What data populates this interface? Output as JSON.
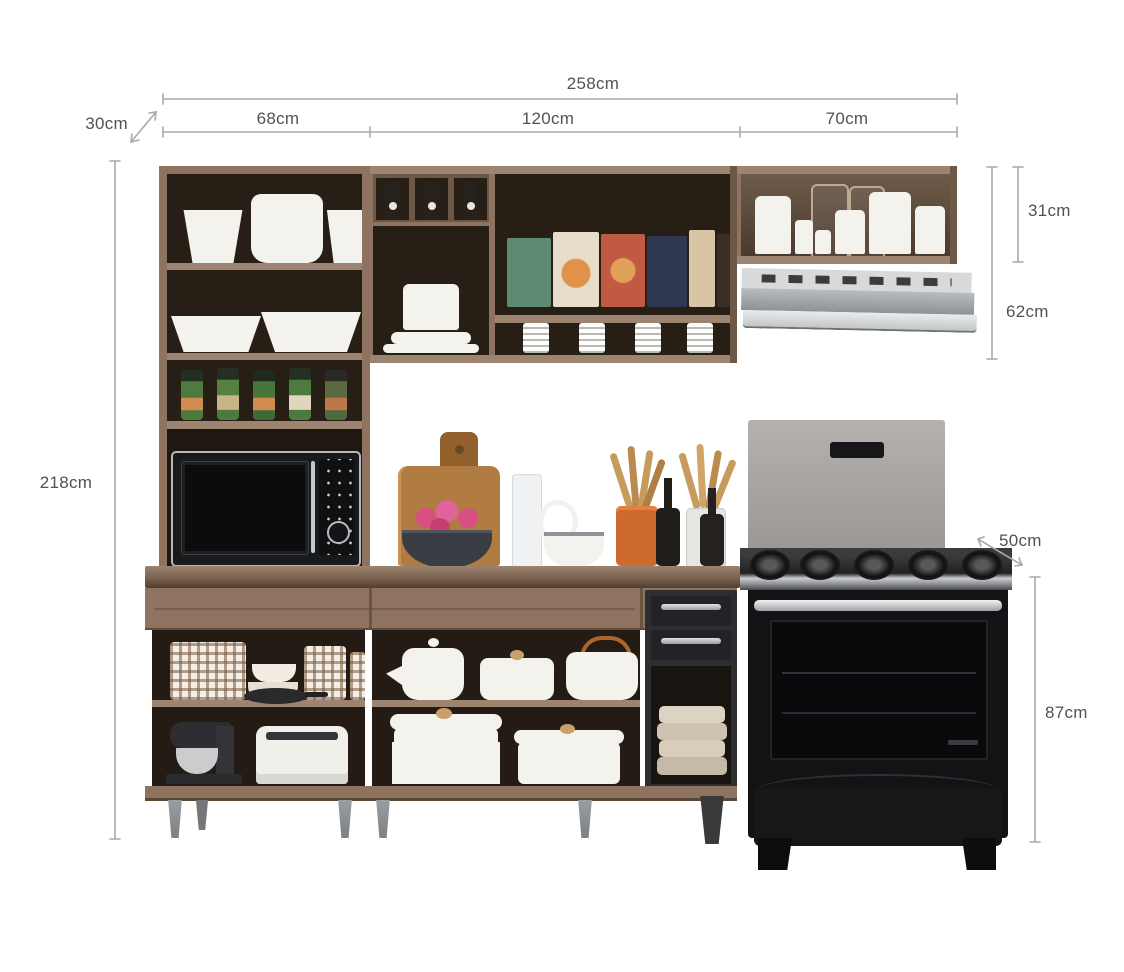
{
  "diagram": {
    "kind": "kitchen cabinet set dimension diagram",
    "unit": "cm"
  },
  "dimensions": {
    "total_width": "258cm",
    "wall_depth": "30cm",
    "left_section_width": "68cm",
    "middle_section_width": "120cm",
    "right_section_width": "70cm",
    "right_upper_cabinet_height": "31cm",
    "right_upper_with_hood_height": "62cm",
    "total_height": "218cm",
    "stove_depth": "50cm",
    "stove_height": "87cm"
  },
  "colors": {
    "background": "#ffffff",
    "dim_line": "#a6aaad",
    "dim_text": "#4f5357",
    "wood": "#8d7360",
    "wood_light": "#9d8470",
    "wood_dark": "#6d5745",
    "interior": "#271e16",
    "dish_white": "#f4f2ed",
    "steel": "#c8cbcd",
    "stove_black": "#131316",
    "backsplash_gray": "#a8a5a3",
    "leg_gray": "#8e9194"
  }
}
